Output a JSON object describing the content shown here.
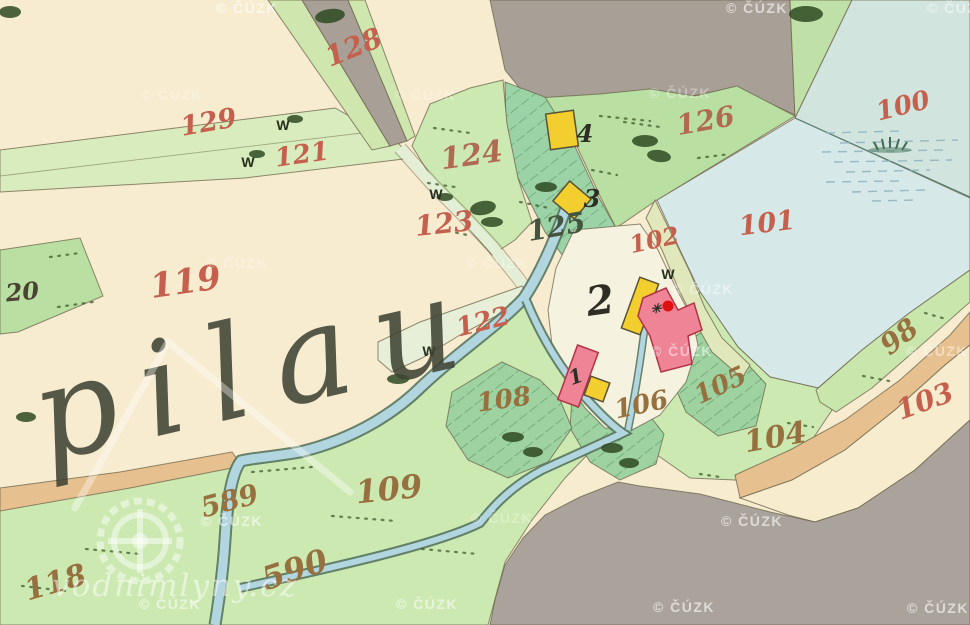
{
  "map": {
    "script_title": "pilau",
    "watermark": {
      "text": "© ČÚZK",
      "site": "vodnimlyny.cz"
    },
    "parcels": {
      "p20": "20",
      "p98": "98",
      "p100": "100",
      "p101": "101",
      "p102": "102",
      "p103": "103",
      "p104": "104",
      "p105": "105",
      "p106": "106",
      "p108": "108",
      "p109": "109",
      "p118": "118",
      "p119": "119",
      "p121": "121",
      "p122": "122",
      "p123": "123",
      "p124": "124",
      "p125": "125",
      "p126": "126",
      "p128": "128",
      "p129": "129",
      "p589": "589",
      "p590": "590"
    },
    "houses": {
      "h1": "1",
      "h2": "2",
      "h3": "3",
      "h4": "4"
    },
    "marks": {
      "meadow_w": "W",
      "mill_star": "✳"
    },
    "palette": {
      "paper_cream": "#f7ecd0",
      "meadow_light": "#cde9b2",
      "meadow_mid": "#b9e0a2",
      "marsh_green": "#9bd3a6",
      "road_gray": "#a8a096",
      "hill_gray": "#aaa39b",
      "pond_blue": "#d5e7e6",
      "stream_blue": "#b2d6e0",
      "road_tan": "#e7c08f",
      "building_wood_yellow": "#f2cf2e",
      "building_masonry_pink": "#ee8496",
      "mill_marker_red": "#e01010",
      "label_red": "#c4604d",
      "label_brown": "#96713f"
    }
  }
}
